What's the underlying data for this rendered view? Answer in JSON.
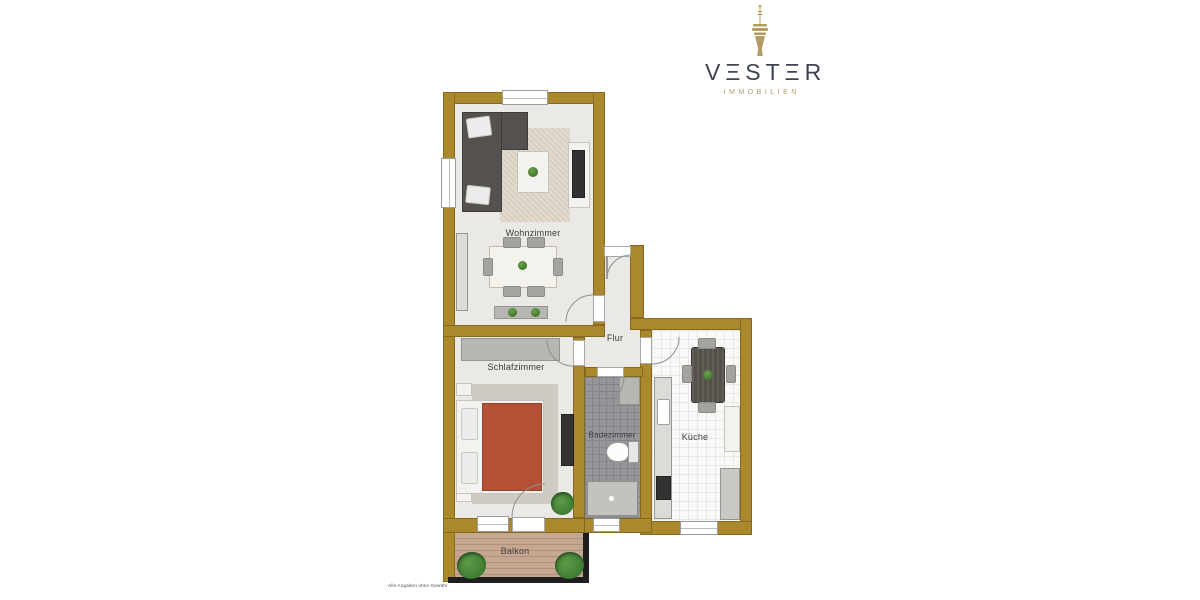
{
  "logo": {
    "brand": "VΞSTΞR",
    "subtitle": "IMMOBILIEN",
    "icon": "rheinturm-tower-icon"
  },
  "rooms": {
    "wohnzimmer": {
      "label": "Wohnzimmer"
    },
    "schlafzimmer": {
      "label": "Schlafzimmer"
    },
    "flur": {
      "label": "Flur"
    },
    "badezimmer": {
      "label": "Badezimmer"
    },
    "kueche": {
      "label": "Küche"
    },
    "balkon": {
      "label": "Balkon"
    }
  },
  "footer": {
    "disclaimer": "Alle Angaben ohne Gewähr"
  },
  "colors": {
    "wall_gold": "#aa882c",
    "floor_light": "#eae9e5",
    "floor_kitchen": "#f9f9f8",
    "floor_bath": "#97969b",
    "sofa_gray": "#54514e",
    "bed_red": "#b25136",
    "plant_green": "#3f7d34",
    "furn_white": "#f3f2ee",
    "furn_gray": "#b7b6b2",
    "logo_text": "#3e4450",
    "logo_gold": "#b29b62"
  }
}
